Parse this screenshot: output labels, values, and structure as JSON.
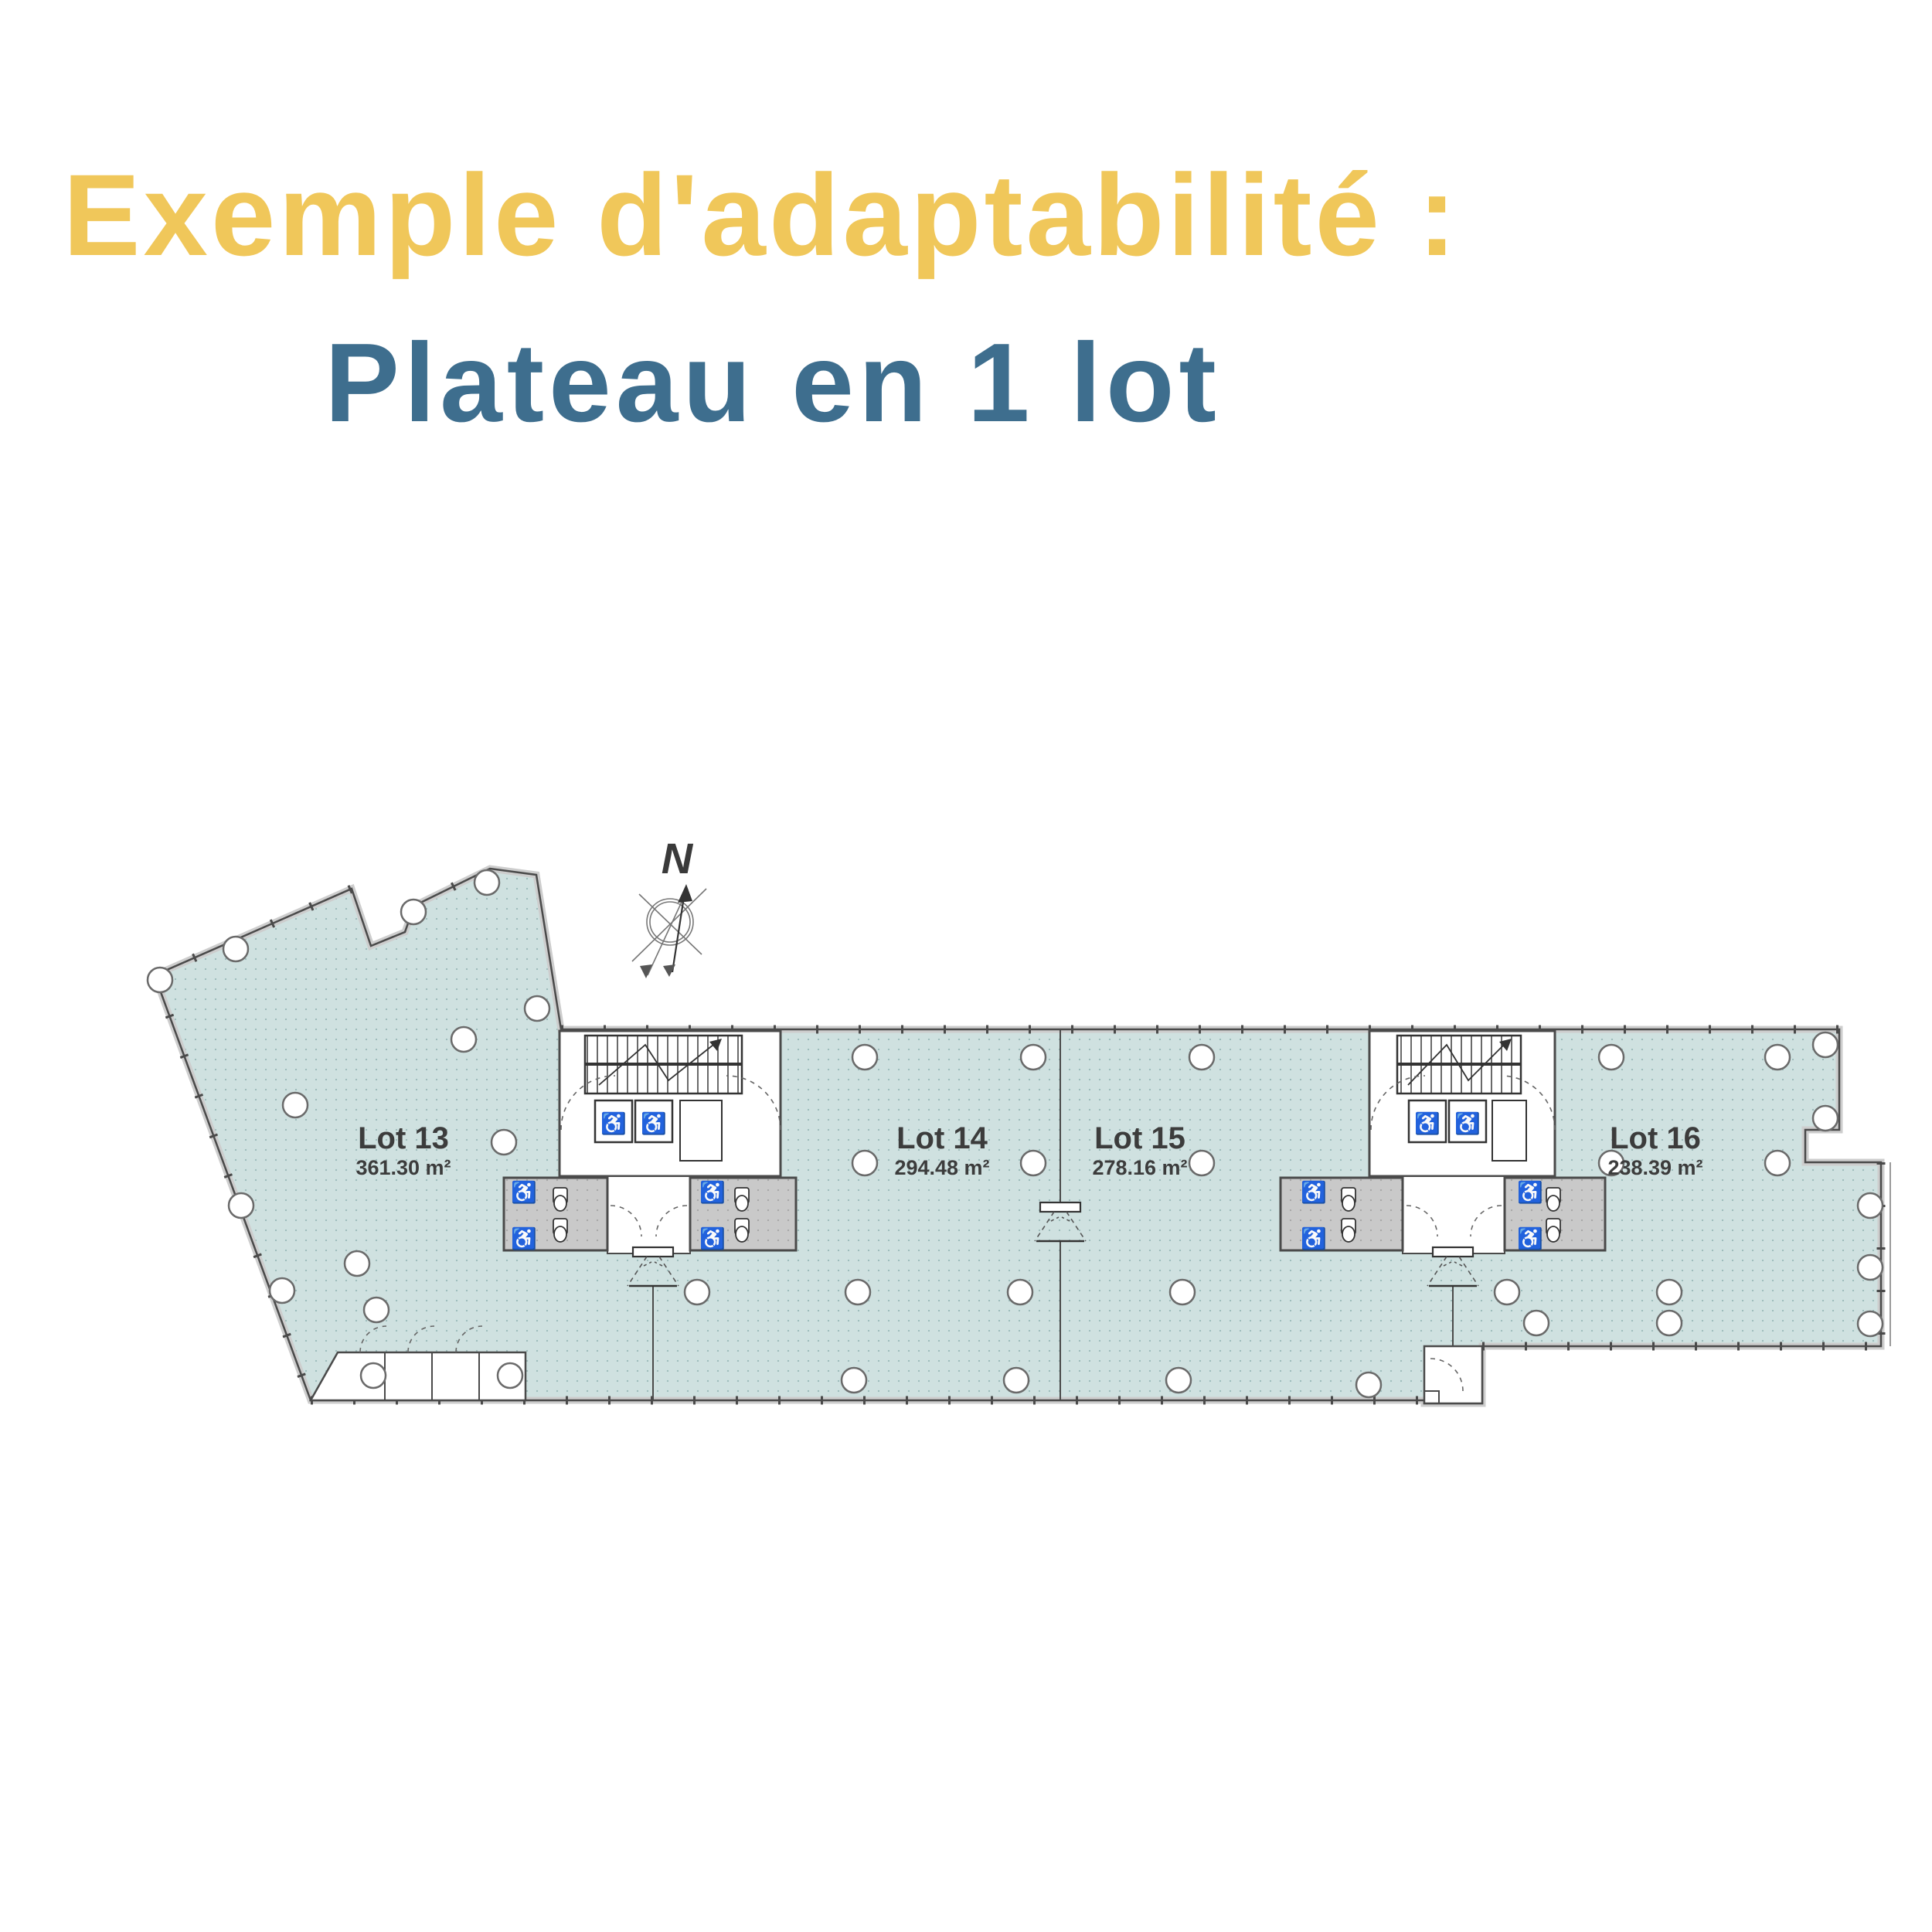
{
  "slide": {
    "title": "Exemple d'adaptabilité :",
    "subtitle": "Plateau en 1 lot"
  },
  "floor_plan": {
    "compass_label": "N",
    "lots": [
      {
        "name": "Lot 13",
        "area": "361.30 m²"
      },
      {
        "name": "Lot 14",
        "area": "294.48 m²"
      },
      {
        "name": "Lot 15",
        "area": "278.16 m²"
      },
      {
        "name": "Lot 16",
        "area": "238.39 m²"
      }
    ],
    "colors": {
      "title": "#f0c75a",
      "subtitle": "#3e6e8e",
      "floor": "#cfe1e0",
      "sanitary": "#c9c9c9",
      "wall": "#4a4a4a"
    }
  }
}
